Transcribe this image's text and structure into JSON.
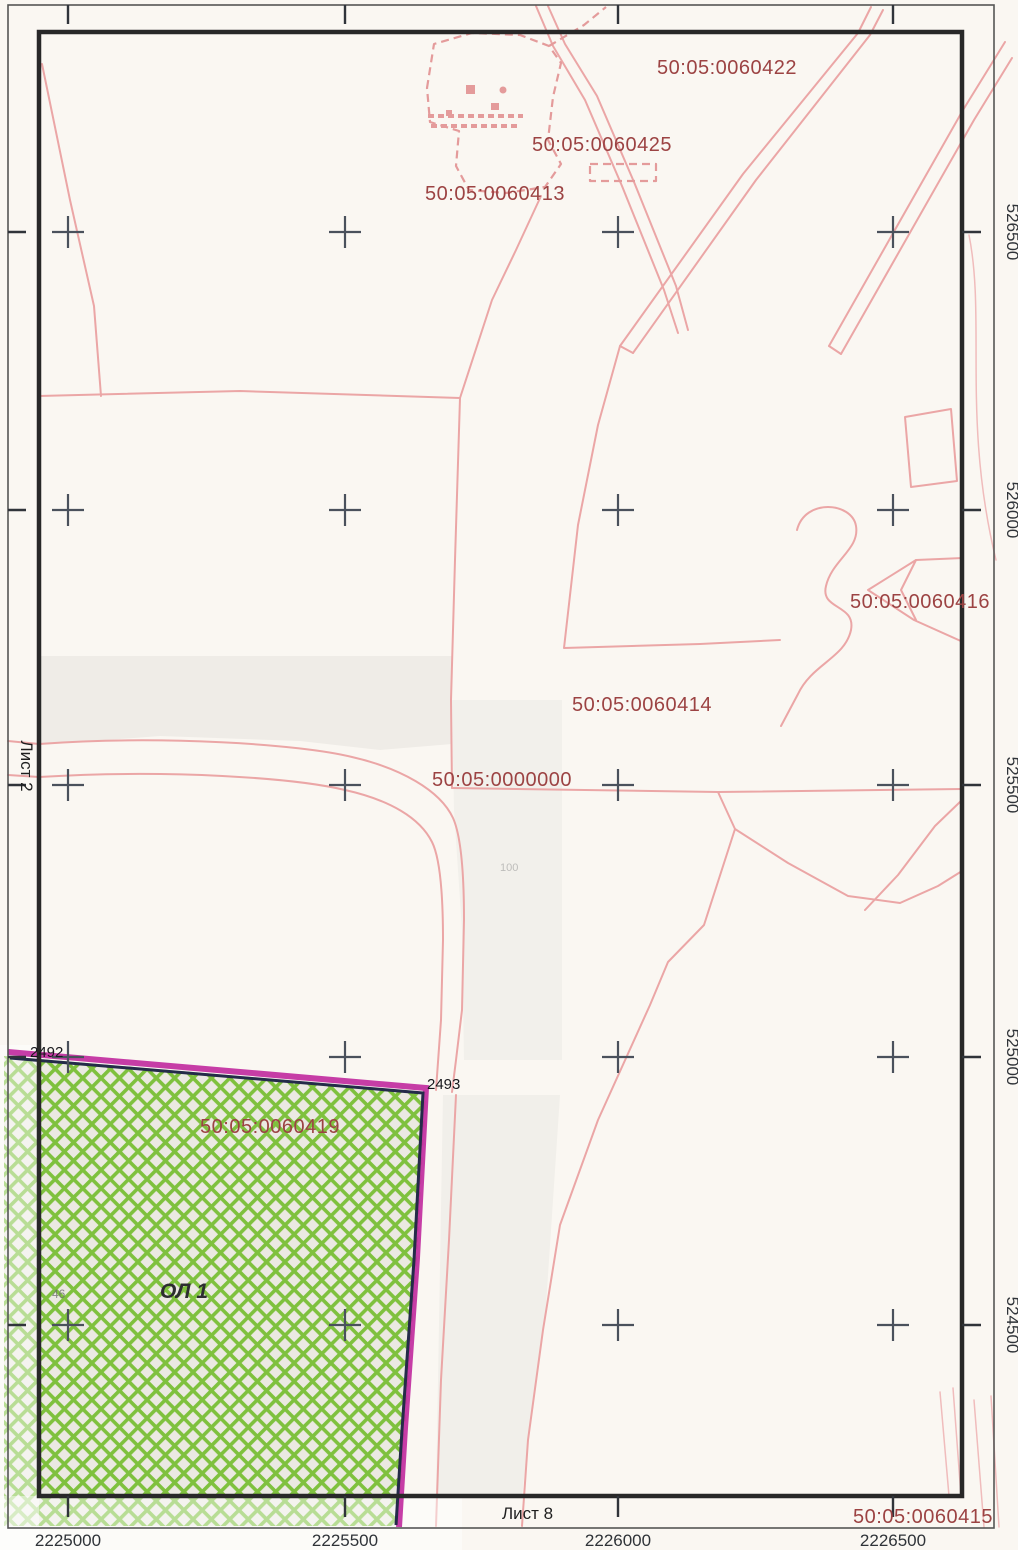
{
  "map": {
    "quarter_labels": [
      {
        "text": "50:05:0060422",
        "x": 727,
        "y": 74
      },
      {
        "text": "50:05:0060425",
        "x": 602,
        "y": 151
      },
      {
        "text": "50:05:0060413",
        "x": 495,
        "y": 200
      },
      {
        "text": "50:05:0060416",
        "x": 920,
        "y": 608
      },
      {
        "text": "50:05:0060414",
        "x": 642,
        "y": 711
      },
      {
        "text": "50:05:0000000",
        "x": 502,
        "y": 786
      },
      {
        "text": "50:05:0060419",
        "x": 270,
        "y": 1133
      }
    ],
    "corner_quarter_label": "50:05:0060415",
    "sheet_left": "Лист 2",
    "sheet_bottom": "Лист 8",
    "parcel": {
      "label": "ОЛ 1",
      "point_start": "2492",
      "point_end": "2493",
      "house_number": "46",
      "road_mark": "100"
    },
    "grid": {
      "x_labels": [
        "2225000",
        "2225500",
        "2226000",
        "2226500"
      ],
      "y_labels": [
        "526500",
        "526000",
        "525500",
        "525000",
        "524500"
      ],
      "x_px": [
        68,
        345,
        618,
        893
      ],
      "y_px": [
        232,
        510,
        785,
        1057,
        1325
      ]
    },
    "colors": {
      "parcel_line": "#eba6a6",
      "quarter_label": "#9c4343",
      "selected_hatch": "#7fc13e",
      "selected_border_magenta": "#c12da0",
      "selected_border_dark": "#242b49",
      "frame": "#282828",
      "cross": "#4a515c"
    }
  }
}
